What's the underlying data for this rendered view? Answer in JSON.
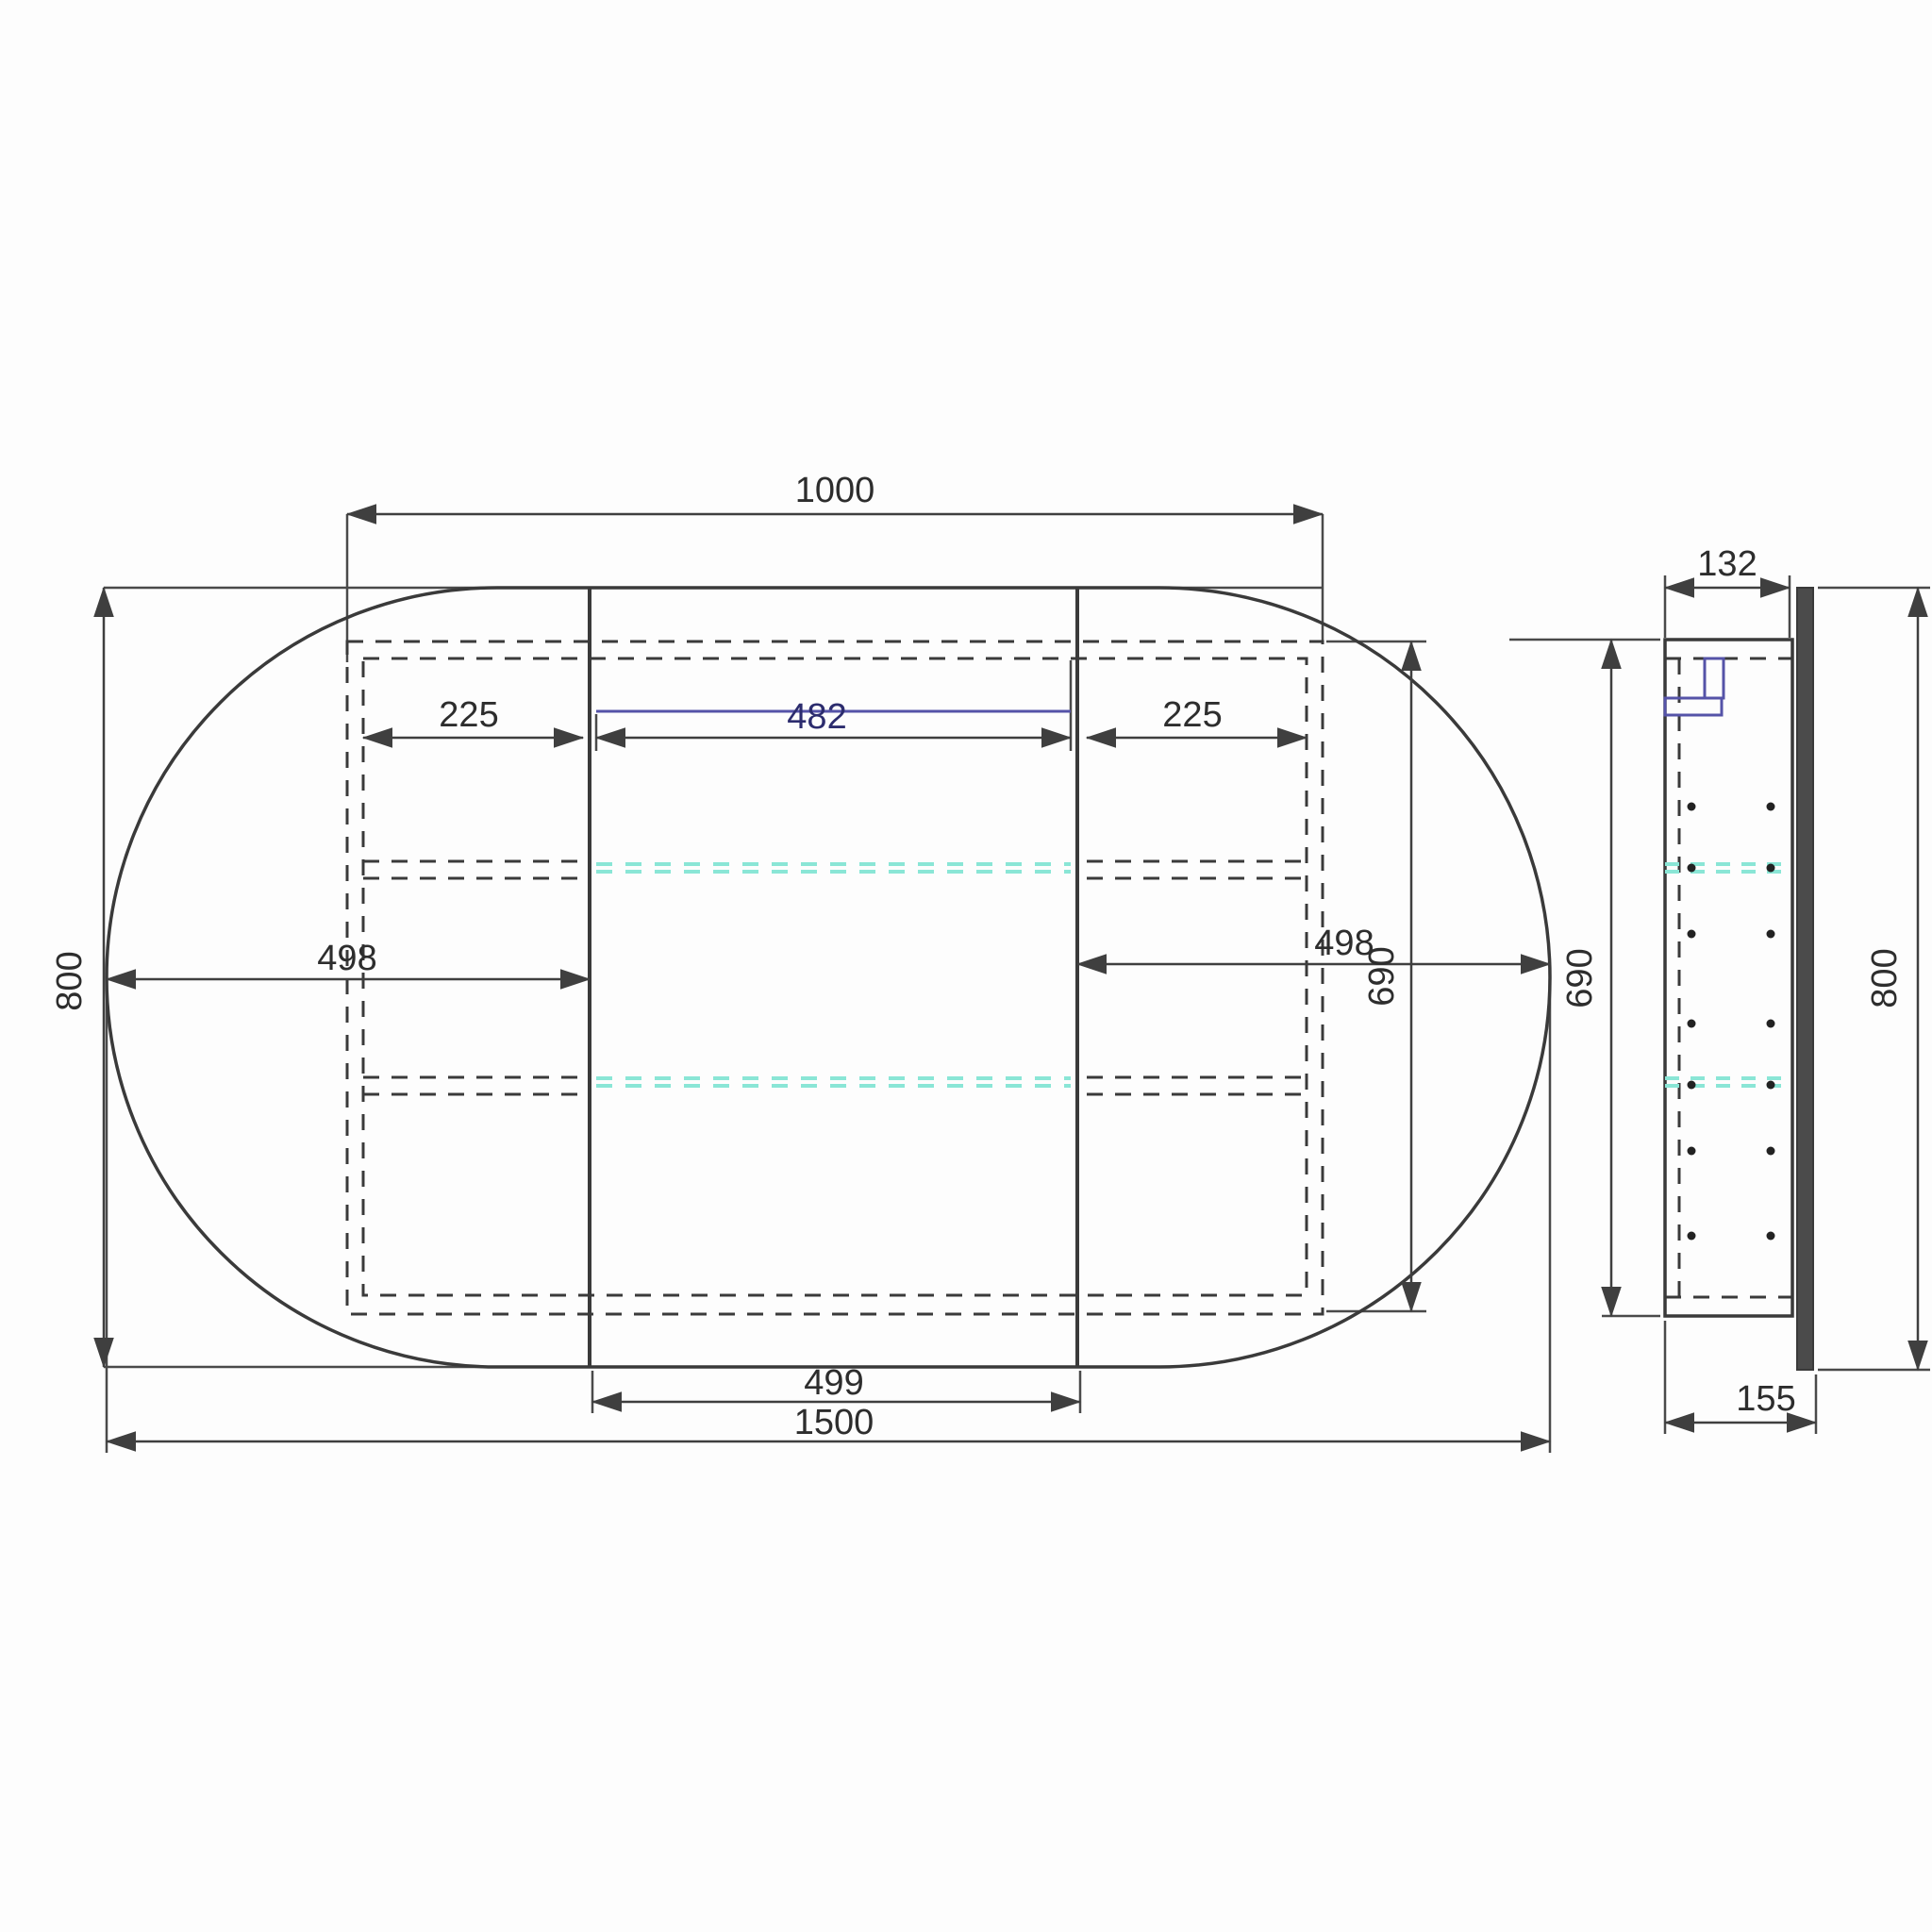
{
  "drawing": {
    "type": "technical-drawing",
    "subject": "oval-mirror-cabinet",
    "front_view": {
      "labels": {
        "carcass_width": "1000",
        "overall_width": "1500",
        "overall_height": "800",
        "carcass_height": "690",
        "left_door_width": "498",
        "right_door_width": "498",
        "centre_door_width": "499",
        "left_bay_width": "225",
        "right_bay_width": "225",
        "led_shelf_width": "482"
      }
    },
    "side_view": {
      "labels": {
        "carcass_depth": "132",
        "overall_depth": "155",
        "overall_height": "800",
        "carcass_height": "690"
      }
    },
    "colors": {
      "line": "#3a3a3a",
      "dim_line": "#3f3f3f",
      "accent_blue": "#5553a8",
      "glass_shelf_cyan": "#8ae6d6",
      "mirror_fill": "#4b4b4b",
      "background": "#fdfdfd"
    }
  }
}
